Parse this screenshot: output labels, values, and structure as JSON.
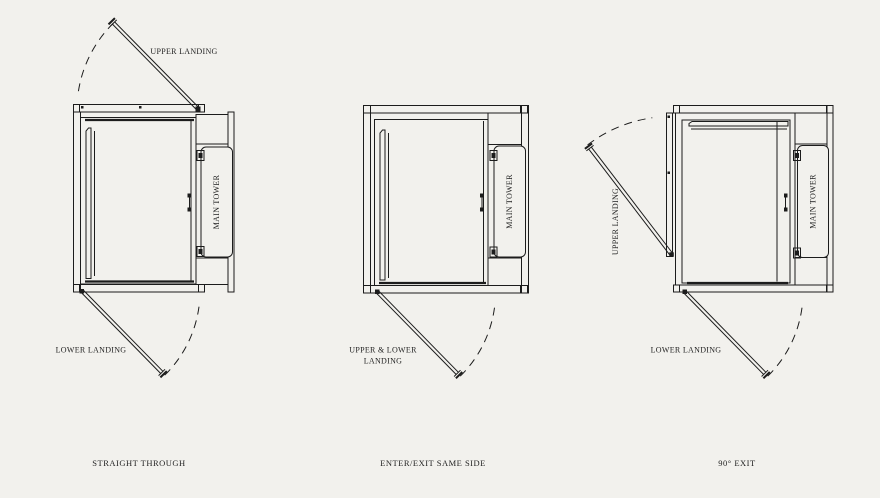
{
  "colors": {
    "background": "#f2f1ed",
    "line": "#1c1c1c",
    "text": "#1f1f1f"
  },
  "diagrams": [
    {
      "caption": "STRAIGHT THROUGH",
      "tower_label": "MAIN TOWER",
      "upper_door_label": "UPPER LANDING",
      "lower_door_label": "LOWER LANDING"
    },
    {
      "caption": "ENTER/EXIT SAME SIDE",
      "tower_label": "MAIN TOWER",
      "door_label_line1": "UPPER & LOWER",
      "door_label_line2": "LANDING"
    },
    {
      "caption": "90° EXIT",
      "tower_label": "MAIN TOWER",
      "upper_door_label": "UPPER LANDING",
      "lower_door_label": "LOWER LANDING"
    }
  ]
}
